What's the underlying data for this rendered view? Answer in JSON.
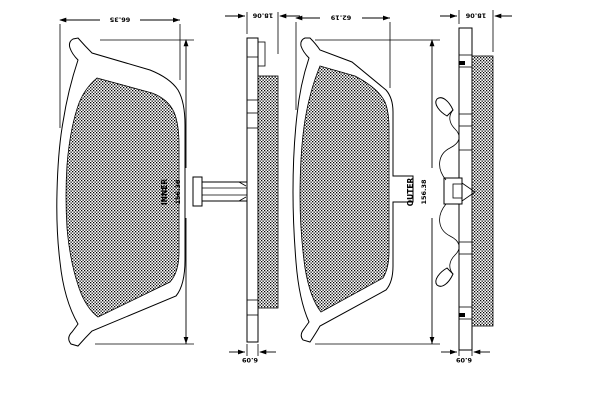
{
  "drawing": {
    "background_color": "#ffffff",
    "line_color": "#000000",
    "hatch_style": "dense-stipple",
    "views": [
      {
        "id": "inner-pad-front",
        "type": "front-view",
        "label": "INNER",
        "dimensions": {
          "width": "66.35",
          "height": "156.38"
        }
      },
      {
        "id": "inner-pad-edge",
        "type": "edge-view",
        "dimensions": {
          "thickness": "18.06",
          "backplate": "6.09"
        }
      },
      {
        "id": "outer-pad-front",
        "type": "front-view",
        "label": "OUTER",
        "dimensions": {
          "width": "62.19",
          "height": "156.38"
        }
      },
      {
        "id": "outer-pad-edge",
        "type": "edge-view",
        "dimensions": {
          "thickness": "18.06",
          "backplate": "6.09"
        }
      }
    ]
  }
}
